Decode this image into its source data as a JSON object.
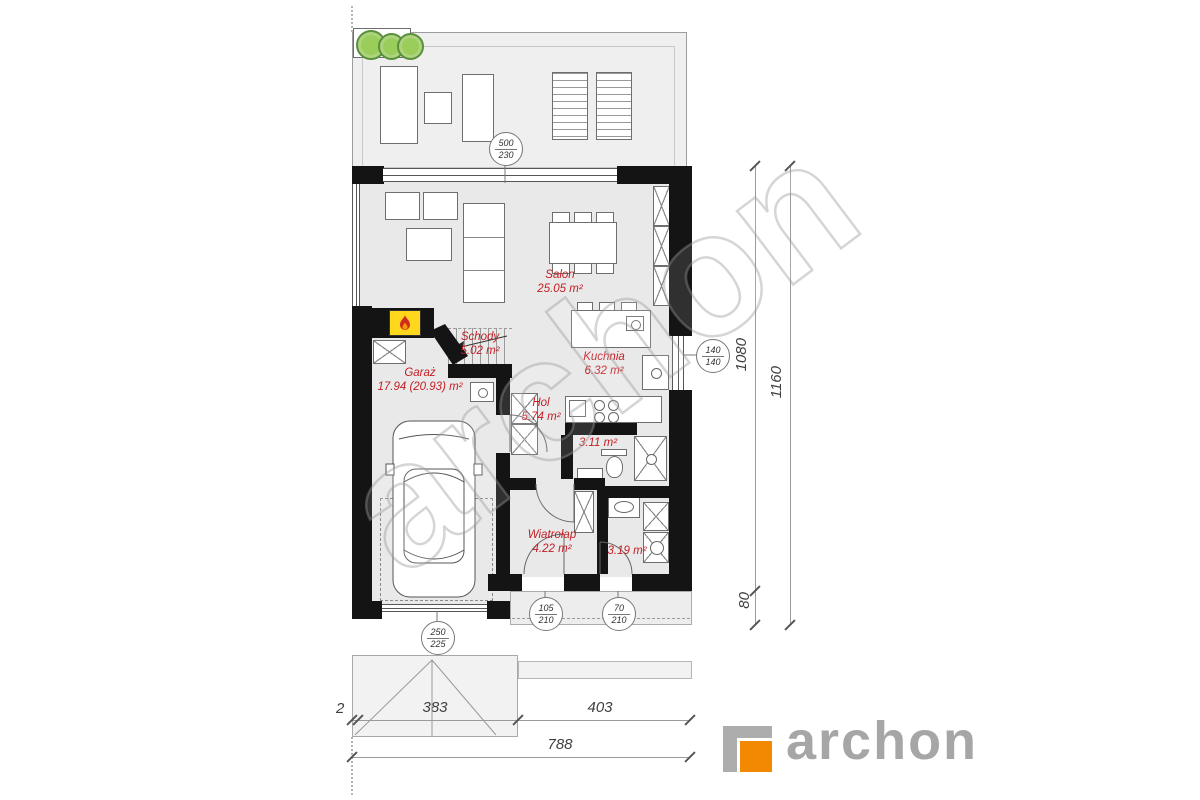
{
  "brand": {
    "watermark": "archon",
    "logo_text": "archon",
    "logo_gray": "#a6a6a6",
    "logo_orange": "#f28900"
  },
  "rooms": [
    {
      "name": "Salon",
      "area": "25.05 m²"
    },
    {
      "name": "Schody",
      "area": "5.02 m²"
    },
    {
      "name": "Garaż",
      "area": "17.94 (20.93) m²"
    },
    {
      "name": "Kuchnia",
      "area": "6.32 m²"
    },
    {
      "name": "Hol",
      "area": "5.74 m²"
    },
    {
      "name": "",
      "area": "3.11 m²"
    },
    {
      "name": "Wiatrołap",
      "area": "4.22 m²"
    },
    {
      "name": "",
      "area": "3.19 m²"
    }
  ],
  "openings": [
    {
      "type": "terrace-window",
      "size_top": "500",
      "size_bottom": "230"
    },
    {
      "type": "kitchen-window",
      "size_top": "140",
      "size_bottom": "140"
    },
    {
      "type": "garage-door",
      "size_top": "250",
      "size_bottom": "225"
    },
    {
      "type": "entry-door",
      "size_top": "105",
      "size_bottom": "210"
    },
    {
      "type": "tech-door",
      "size_top": "70",
      "size_bottom": "210"
    }
  ],
  "dimensions": {
    "right_inner_main": "1080",
    "right_inner_porch": "80",
    "right_total": "1160",
    "bottom_offset": "2",
    "bottom_garage": "383",
    "bottom_right": "403",
    "bottom_total": "788"
  },
  "colors": {
    "wall": "#141414",
    "room_fill": "#e9e9e9",
    "terrace_fill": "#efefef",
    "label_red": "#c41e25",
    "fireplace_yellow": "#ffd71c",
    "tree_green": "#9acd5a"
  }
}
